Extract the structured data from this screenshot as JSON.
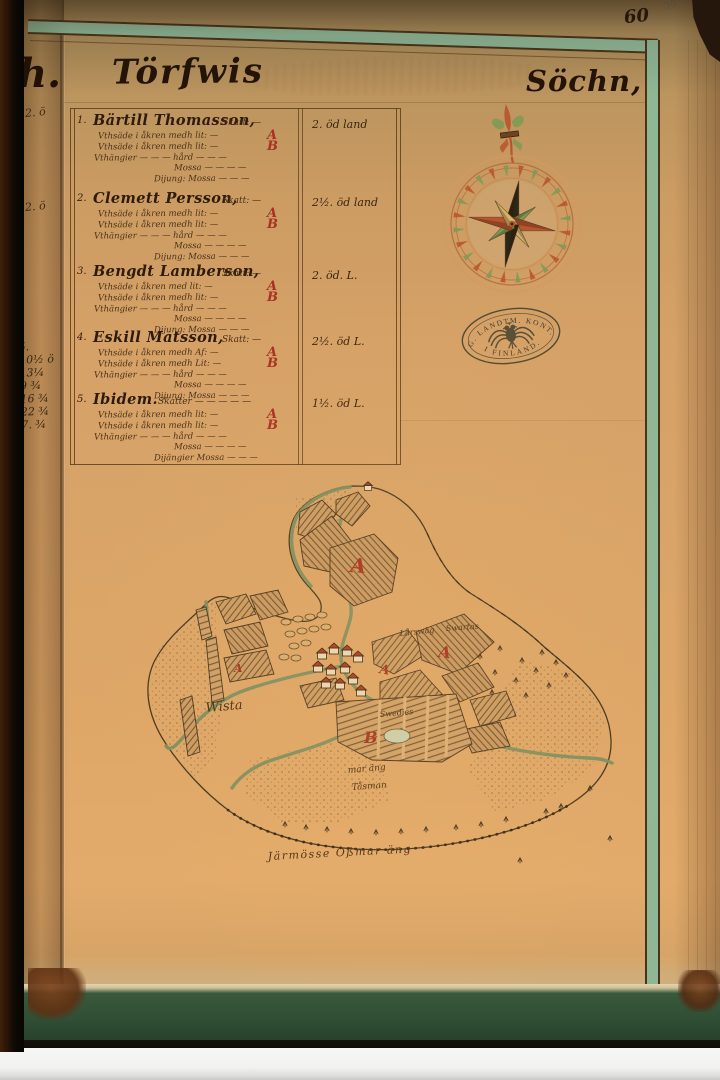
{
  "page": {
    "folio": "60",
    "pencil_note": "30",
    "title_left": "Törfwis",
    "title_right": "Söchn,"
  },
  "margin": {
    "partial_letter": "h.",
    "note1": "2. ö",
    "note2": "2. ö",
    "numbers": [
      "5.",
      "10½ ö",
      "13¼",
      "9 ¾",
      "16 ¾",
      "22 ¾",
      "7. ¾"
    ]
  },
  "table": {
    "entries": [
      {
        "num": "1.",
        "name": "Bärtill Thomasson,",
        "suffix": "Skatt: —",
        "value": "2. öd land",
        "lines": [
          {
            "t": "Vthsäde i åkren medh lit: —",
            "m": "A"
          },
          {
            "t": "Vthsäde i åkren medh lit: —",
            "m": "B"
          },
          {
            "t": "Vthängier — — — hård — — —",
            "m": ""
          },
          {
            "t": "Mossa — — — —",
            "m": ""
          },
          {
            "t": "Dijung: Mossa — — —",
            "m": ""
          }
        ]
      },
      {
        "num": "2.",
        "name": "Clemett Persson,",
        "suffix": "Skatt: —",
        "value": "2½. öd land",
        "lines": [
          {
            "t": "Vthsäde i åkren medh lit: —",
            "m": "A"
          },
          {
            "t": "Vthsäde i åkren medh lit: —",
            "m": "B"
          },
          {
            "t": "Vthängier — — — hård — — —",
            "m": ""
          },
          {
            "t": "Mossa — — — —",
            "m": ""
          },
          {
            "t": "Dijung: Mossa — — —",
            "m": ""
          }
        ]
      },
      {
        "num": "3.",
        "name": "Bengdt Lamberson,",
        "suffix": "Skatt: —",
        "value": "2. öd. L.",
        "lines": [
          {
            "t": "Vthsäde i åkren med lit: —",
            "m": "A"
          },
          {
            "t": "Vthsäde i åkren medh lit: —",
            "m": "B"
          },
          {
            "t": "Vthängier — — — hård — — —",
            "m": ""
          },
          {
            "t": "Mossa — — — —",
            "m": ""
          },
          {
            "t": "Dijung: Mossa — — —",
            "m": ""
          }
        ]
      },
      {
        "num": "4.",
        "name": "Eskill Matsson,",
        "suffix": "Skatt: —",
        "value": "2½. öd L.",
        "lines": [
          {
            "t": "Vthsäde i åkren medh Af: —",
            "m": "A"
          },
          {
            "t": "Vthsäde i åkren medh Lit: —",
            "m": "B"
          },
          {
            "t": "Vthängier — — — hård — — —",
            "m": ""
          },
          {
            "t": "Mossa — — — —",
            "m": ""
          },
          {
            "t": "Dijung: Mossa — — —",
            "m": ""
          }
        ]
      },
      {
        "num": "5.",
        "name": "Ibidem.",
        "suffix": "Skatter — — — — —",
        "value": "1½. öd L.",
        "lines": [
          {
            "t": "Vthsäde i åkren medh lit: —",
            "m": "A"
          },
          {
            "t": "Vthsäde i åkren medh lit: —",
            "m": "B"
          },
          {
            "t": "Vthängier — — — hård — — —",
            "m": ""
          },
          {
            "t": "Mossa — — — —",
            "m": ""
          },
          {
            "t": "Dijängier Mossa — — —",
            "m": ""
          }
        ]
      }
    ]
  },
  "compass": {
    "icon": "compass-rose-icon",
    "finial": "fleur-de-lis-icon"
  },
  "stamp": {
    "top": "G. LANDTM. KONT.",
    "bottom": "I FINLAND.",
    "emblem": "double-eagle-icon"
  },
  "map": {
    "labels": [
      {
        "text": "Wista"
      },
      {
        "text": "mar äng"
      },
      {
        "text": "Tåsman"
      },
      {
        "text": "Järmösse Oßmar äng"
      },
      {
        "text": "Lårswäg"
      },
      {
        "text": "Swartas"
      },
      {
        "text": "Swedies"
      }
    ],
    "letters": [
      {
        "char": "A"
      },
      {
        "char": "A"
      },
      {
        "char": "A"
      },
      {
        "char": "B"
      },
      {
        "char": "A"
      }
    ]
  },
  "colors": {
    "ink": "#33200f",
    "red_letter": "#a83222",
    "band_green": "#8fb796",
    "compass_red": "#b8542e",
    "compass_green": "#7f9a55",
    "stamp_ink": "#403c2c",
    "cloth_green": "#2f4e34"
  }
}
